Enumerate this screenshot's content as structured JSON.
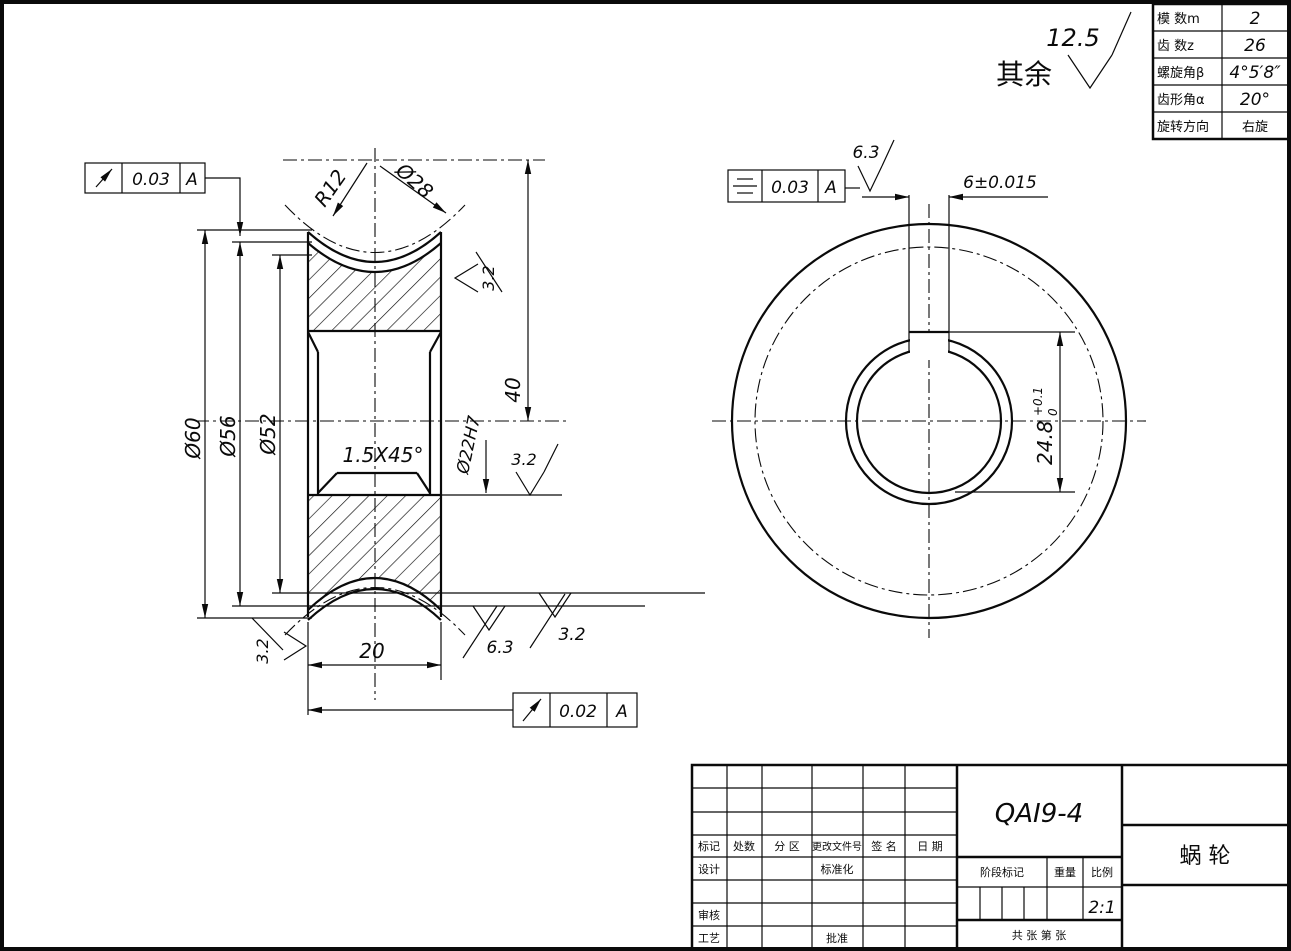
{
  "general_note": {
    "prefix": "其余",
    "roughness": "12.5"
  },
  "param_table": {
    "rows": [
      {
        "label": "模 数m",
        "value": "2"
      },
      {
        "label": "齿 数z",
        "value": "26"
      },
      {
        "label": "螺旋角β",
        "value": "4°5′8″"
      },
      {
        "label": "齿形角α",
        "value": "20°"
      },
      {
        "label": "旋转方向",
        "value": "右旋"
      }
    ]
  },
  "section_view": {
    "dia60": "Ø60",
    "dia56": "Ø56",
    "dia52": "Ø52",
    "bore": "Ø22H7",
    "worm_dia": "Ø28",
    "throat_radius": "R12",
    "height_40": "40",
    "width_20": "20",
    "chamfer": "1.5X45°",
    "roughness_rim": "3.2",
    "roughness_bore": "3.2",
    "roughness_throat": "6.3",
    "roughness_face_right": "3.2",
    "roughness_face_left": "3.2",
    "runout_top": {
      "value": "0.03",
      "datum": "A"
    },
    "runout_bottom": {
      "value": "0.02",
      "datum": "A"
    }
  },
  "front_view": {
    "keyway_width": "6±0.015",
    "keyway_depth": "24.8",
    "keyway_depth_tol_upper": "+0.1",
    "keyway_depth_tol_lower": "0",
    "roughness_keyway": "6.3",
    "symmetry": {
      "value": "0.03",
      "datum": "A"
    }
  },
  "title_block": {
    "drawing_number": "QAI9-4",
    "part_name": "蜗  轮",
    "scale_value": "2:1",
    "header_cells": [
      "标记",
      "处数",
      "分 区",
      "更改文件号",
      "签 名",
      "日 期"
    ],
    "row_design": "设计",
    "row_standard": "标准化",
    "row_check": "审核",
    "row_process": "工艺",
    "row_approve": "批准",
    "stage_label": "阶段标记",
    "weight_label": "重量",
    "scale_label": "比例",
    "sheet_label": "共 张 第 张"
  }
}
